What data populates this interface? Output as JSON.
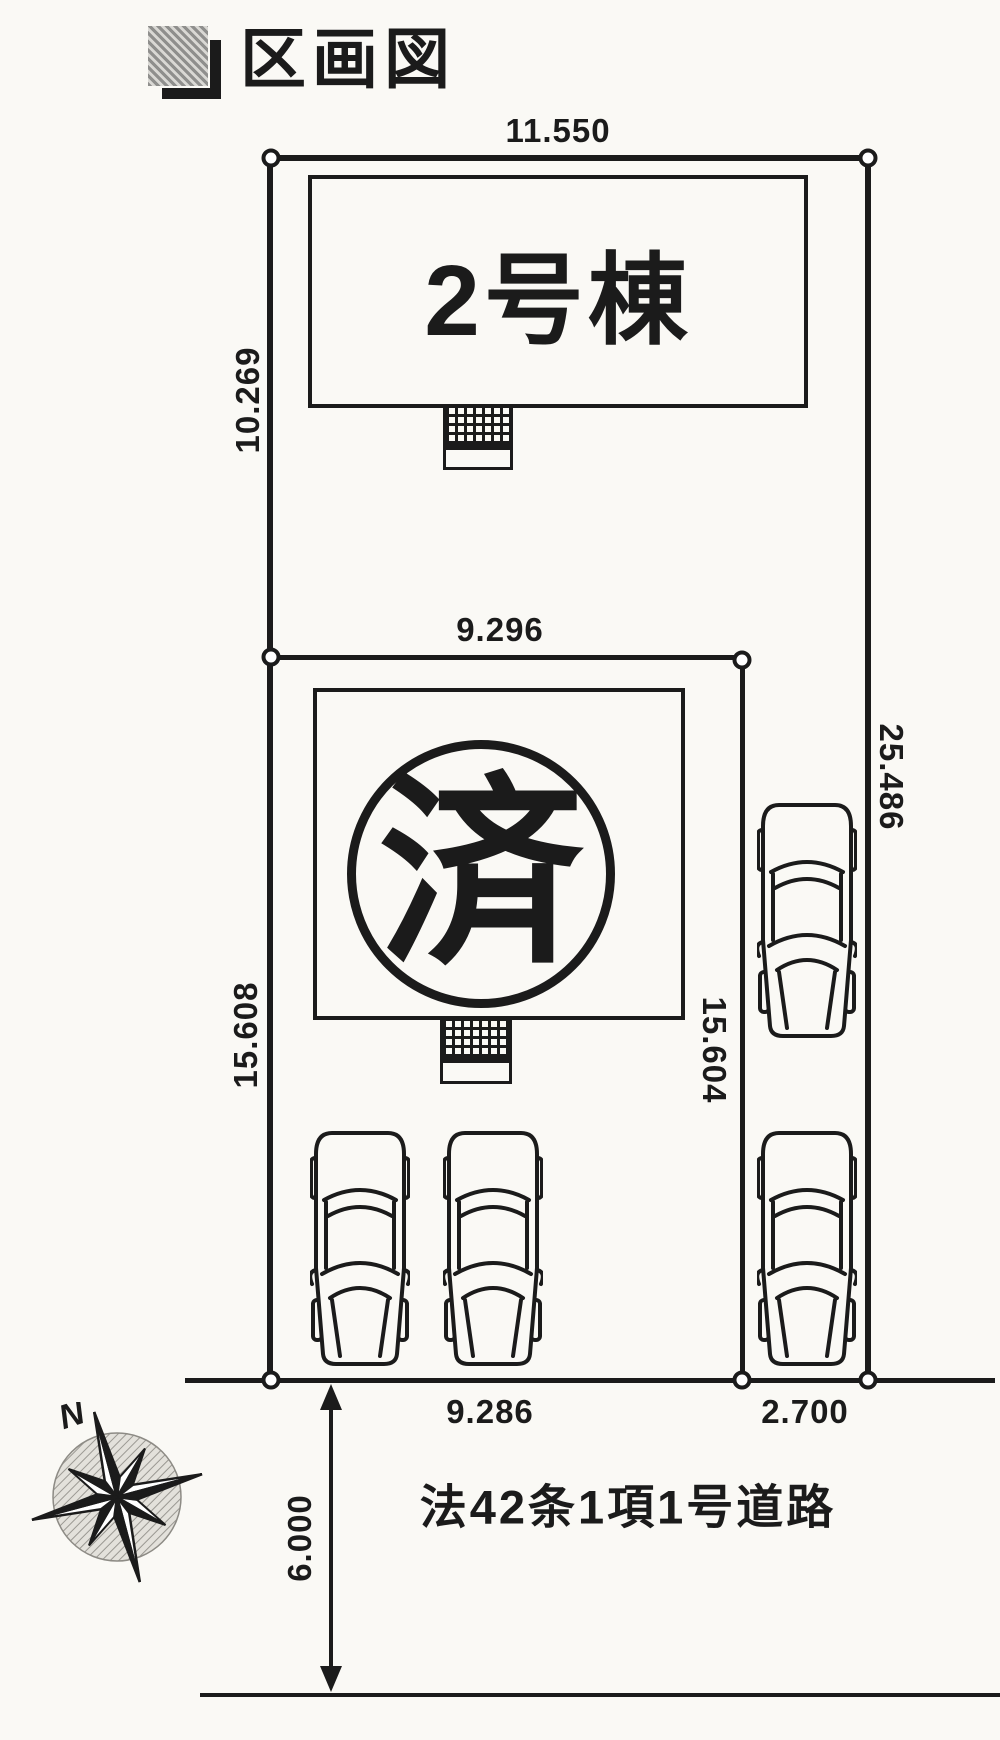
{
  "header": {
    "title": "区画図"
  },
  "lot": {
    "upper_building_label": "2号棟",
    "lower_building_mark": "済",
    "road_label": "法42条1項1号道路",
    "compass_north": "N",
    "dims": {
      "top": "11.550",
      "upper_left": "10.269",
      "mid": "9.296",
      "right": "25.486",
      "lower_left": "15.608",
      "lower_mid": "15.604",
      "frontage_main": "9.286",
      "frontage_side": "2.700",
      "road_width": "6.000"
    }
  },
  "colors": {
    "ink": "#1b1b1b",
    "paper": "#faf9f5"
  }
}
